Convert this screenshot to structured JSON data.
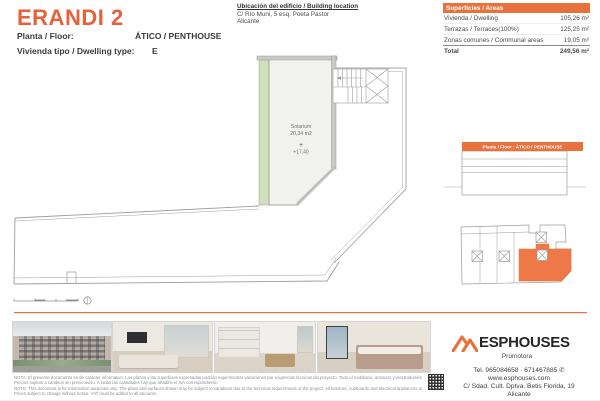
{
  "page": {
    "title": "ERANDI 2"
  },
  "header": {
    "floor_label": "Planta / Floor:",
    "floor_value": "ÁTICO / PENTHOUSE",
    "type_label": "Vivienda tipo / Dwelling type:",
    "type_value": "E"
  },
  "location": {
    "title": "Ubicación del edificio / Building location",
    "address_line1": "C/ Río Muni, 5 esq. Poeta Pastor",
    "address_line2": "Alicante"
  },
  "areas_table": {
    "header": "Superficies / Areas",
    "rows": [
      {
        "label": "Vivienda / Dwelling",
        "value": "105,26 m²"
      },
      {
        "label": "Terrazas / Terraces(100%)",
        "value": "125,25 m²"
      },
      {
        "label": "Zonas comunes / Communal areas",
        "value": "19,05 m²"
      }
    ],
    "total_label": "Total",
    "total_value": "249,56 m²"
  },
  "floor_plan": {
    "room_label": "Solarium",
    "room_area": "20,34 m2",
    "level_symbol": "+",
    "level_value": "+17,40"
  },
  "key_diagrams": {
    "elevation_header": "Planta / Floor : ÁTICO / PENTHOUSE"
  },
  "photos": [
    {
      "name": "building-exterior"
    },
    {
      "name": "living-room"
    },
    {
      "name": "kitchen-dining"
    },
    {
      "name": "bedroom"
    }
  ],
  "disclaimer": {
    "es_line1": "NOTA: El presente documento es de carácter informativo. Los planos y las superficies expresadas podrían experimentar variaciones por exigencias técnicas del proyecto. Todo el mobiliario, armarios y electrodomésticos son meramente decorativos.",
    "es_line2": "Precios sujetos a cambios sin previo aviso. A todas las cantidades hay que añadirle el IVA correspondiente.",
    "en_line1": "NOTE: This document is for information purposes only. The plans and surfaces shown may be subject to variations due to the technical requirements of the project. All furniture, cupboards and electrical appliances are purely decorative.",
    "en_line2": "Prices subject to change without notice. VAT must be added to all amounts."
  },
  "brand": {
    "name": "ESPHOUSES",
    "tagline": "Promotora",
    "phone": "Tel. 965084658 · 671467885",
    "phone_icon": "✆",
    "website": "www.esphouses.com",
    "address_line1": "C/ Sdad. Cult. Dptva. Betis Florida, 19",
    "address_line2": "Alicante"
  },
  "colors": {
    "accent": "#E8713C",
    "plan_green": "#CFE0BA"
  }
}
